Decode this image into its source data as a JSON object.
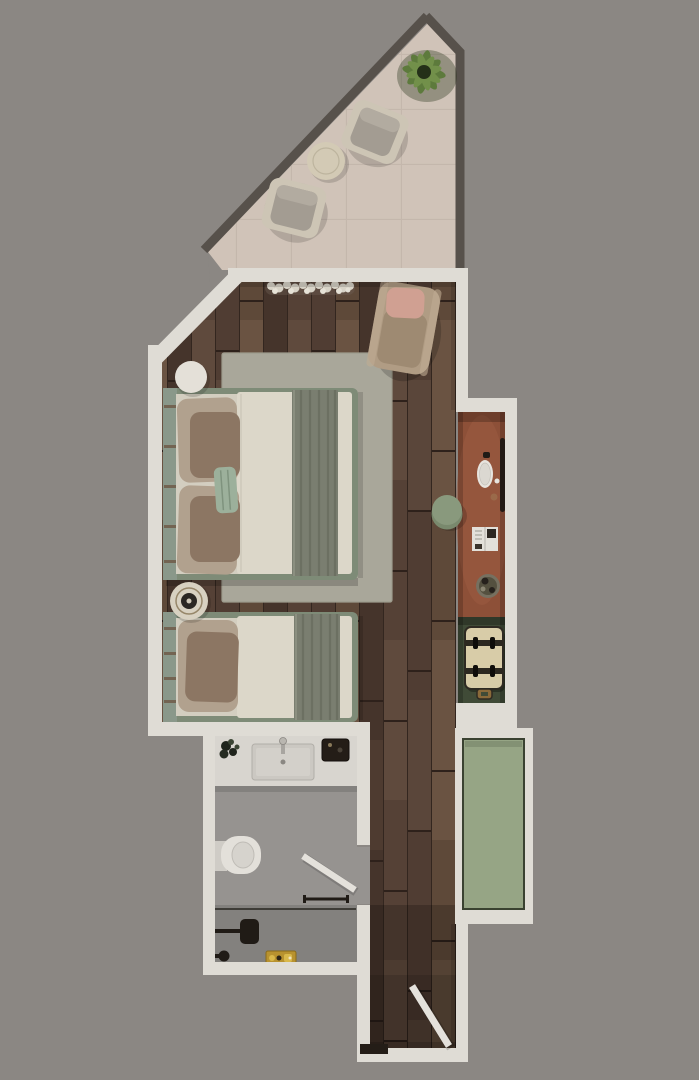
{
  "scene": {
    "kind": "top-down 3d rendered floor plan of a hotel guest room",
    "rooms": [
      {
        "name": "terrace",
        "floor": "beige-tile",
        "furniture": [
          "potted-plant",
          "lounge-chair",
          "coffee-table",
          "lounge-chair"
        ]
      },
      {
        "name": "bedroom",
        "floor": "dark-wood-plank",
        "furniture": [
          "doormat",
          "reading-armchair-with-pink-cushion",
          "area-rug",
          "double-bed",
          "single-bed",
          "round-nightstand",
          "decor-tray",
          "side-stool"
        ]
      },
      {
        "name": "vanity-nook",
        "floor": "terracotta-counter",
        "furniture": [
          "wall-rail",
          "vessel-basin",
          "faucet",
          "magazine",
          "decor-bowl"
        ]
      },
      {
        "name": "luggage-niche",
        "floor": "dark-green",
        "furniture": [
          "suitcase"
        ]
      },
      {
        "name": "wardrobe-panel",
        "floor": "sage-green-panel",
        "furniture": []
      },
      {
        "name": "bathroom",
        "floor": "grey-stone",
        "furniture": [
          "vanity-counter",
          "basin",
          "faucet",
          "plant",
          "amenity-tray",
          "wall-hung-toilet",
          "swing-door",
          "towel-bar",
          "shower-screen",
          "shower-head",
          "shower-valve",
          "toiletries-tray"
        ]
      },
      {
        "name": "entry-corridor",
        "floor": "dark-wood-plank",
        "furniture": [
          "entry-door",
          "threshold"
        ]
      }
    ]
  },
  "colors": {
    "bg": "#8b8783",
    "wall": "#dfdcd5",
    "wallShadow": "#b7b4ae",
    "terraceWall": "#57514b",
    "terraceFloor": "#d0c3b8",
    "tileLine": "#c2b5aa",
    "plantDark": "#243018",
    "plantGreen": "#5d7a3c",
    "plantLight": "#72904a",
    "terraceChairFrame": "#cdc5b5",
    "terraceChairCushion": "#a39c92",
    "tableCream": "#d3cab5",
    "wood1": "#5f4a3d",
    "wood2": "#503d33",
    "wood3": "#6a5342",
    "wood4": "#45342b",
    "woodGap": "#33261f",
    "woodJoint": "#2e211b",
    "rug": "#a9a79a",
    "rugEdge": "#9b9a8c",
    "bedFrame": "#7e8b77",
    "headboard": "#8a988a",
    "slat": "#6f5b49",
    "duvet": "#dcd7c9",
    "mattress": "#d3cec0",
    "blanket": "#7a7e70",
    "blanketStripe": "#686c5e",
    "blanketLight": "#8b8f80",
    "pillowBeige": "#b1a18e",
    "pillowBrown": "#8c7663",
    "pillowSage": "#9cb09b",
    "nightstand": "#e4e0d8",
    "trayCream": "#d8d1c1",
    "trayRing": "#97876a",
    "trayDark": "#2b2723",
    "chairTan": "#b09c84",
    "chairSeat": "#9e8a72",
    "cushionPink": "#d0a092",
    "stoolGreen": "#89997d",
    "stoolGreenDark": "#79896d",
    "terracotta": "#8d5038",
    "terracottaLight": "#9d5b41",
    "railDark": "#231a14",
    "basinWhite": "#e7e4de",
    "copper": "#9a6a4a",
    "bowlOuter": "#767060",
    "bowlInner": "#54503f",
    "magazine": "#e3e0da",
    "nicheGreen": "#404b37",
    "suitcase": "#d8cca8",
    "strapDark": "#2c2820",
    "handleTan": "#8a6a3a",
    "sagePanel": "#96a585",
    "sageEdge": "#3a4231",
    "bathFloor": "#969390",
    "counter": "#d8d5cf",
    "sinkFill": "#cbc8c2",
    "sinkEdge": "#aeaba5",
    "toilet": "#e3e0da",
    "fixtureDark": "#201b16",
    "gold": "#b8922f",
    "goldLight": "#d9b84a",
    "doorLeaf": "#e4e1db",
    "threshold": "#241d17",
    "doormat": "#d8d3c7",
    "doormatDot": "#e6e2d7",
    "doormatShadow": "#6f6054"
  }
}
